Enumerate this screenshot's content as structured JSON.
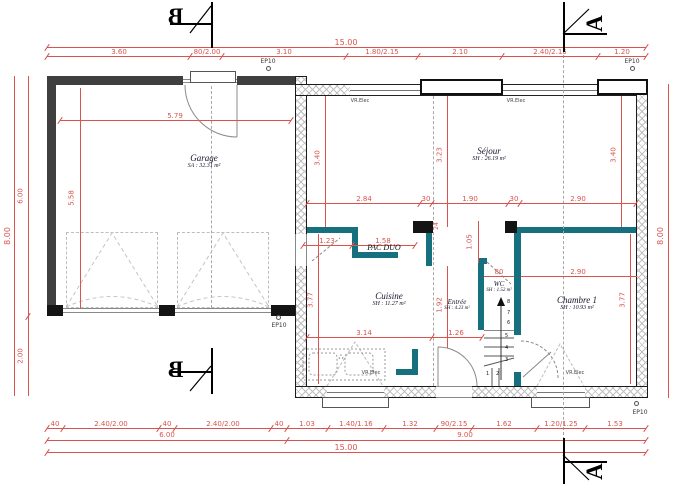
{
  "colors": {
    "dimension": "#d9534f",
    "partition": "#17707e",
    "wall": "#1c1c1c"
  },
  "sections": {
    "left": "B",
    "right": "A"
  },
  "dims": {
    "top_total": "15.00",
    "top_chain": [
      "3.60",
      "80/2.00",
      "3.10",
      "1.80/2.15",
      "2.10",
      "2.40/2.15",
      "1.20"
    ],
    "bottom_chain": [
      "40",
      "2.40/2.00",
      "40",
      "2.40/2.00",
      "40",
      "1.03",
      "1.40/1.16",
      "1.32",
      "90/2.15",
      "1.62",
      "1.20/1.25",
      "1.53"
    ],
    "bottom_garage": "6.00",
    "bottom_house": "9.00",
    "bottom_total": "15.00",
    "left": {
      "total": "8.00",
      "garage": "6.00",
      "below": "2.00"
    },
    "right": {
      "total": "8.00"
    },
    "garage": {
      "w": "5.79",
      "h": "5.58"
    },
    "sejour": {
      "left": "3.40",
      "mid": "3.23",
      "right": "3.40",
      "chain": [
        "2.84",
        "30",
        "1.90",
        "30",
        "2.90"
      ]
    },
    "pac": {
      "a": "1.23",
      "b": "1.58",
      "c": "24",
      "d": "1.05"
    },
    "cuisine": {
      "h": "3.77",
      "w": "3.14"
    },
    "entree": {
      "h": "1.92",
      "w": "1.26"
    },
    "wc": {
      "door": "80"
    },
    "chambre": {
      "w": "2.90",
      "h": "3.77"
    }
  },
  "rooms": {
    "garage": {
      "name": "Garage",
      "area": "SA : 32.31 m²"
    },
    "sejour": {
      "name": "Séjour",
      "area": "SH : 26.19 m²"
    },
    "cuisine": {
      "name": "Cuisine",
      "area": "SH : 11.27 m²"
    },
    "entree": {
      "name": "Entrée",
      "area": "SH : 4.23 m²"
    },
    "wc": {
      "name": "WC",
      "area": "SH : 1.52 m²"
    },
    "chambre": {
      "name": "Chambre 1",
      "area": "SH : 10.93 m²"
    }
  },
  "labels": {
    "pac": "PAC DUO",
    "vr_elec": "VR.Elec",
    "ep10": "EP10"
  },
  "stairs": {
    "steps": [
      "1",
      "2",
      "3",
      "4",
      "5",
      "6",
      "7",
      "8"
    ]
  }
}
